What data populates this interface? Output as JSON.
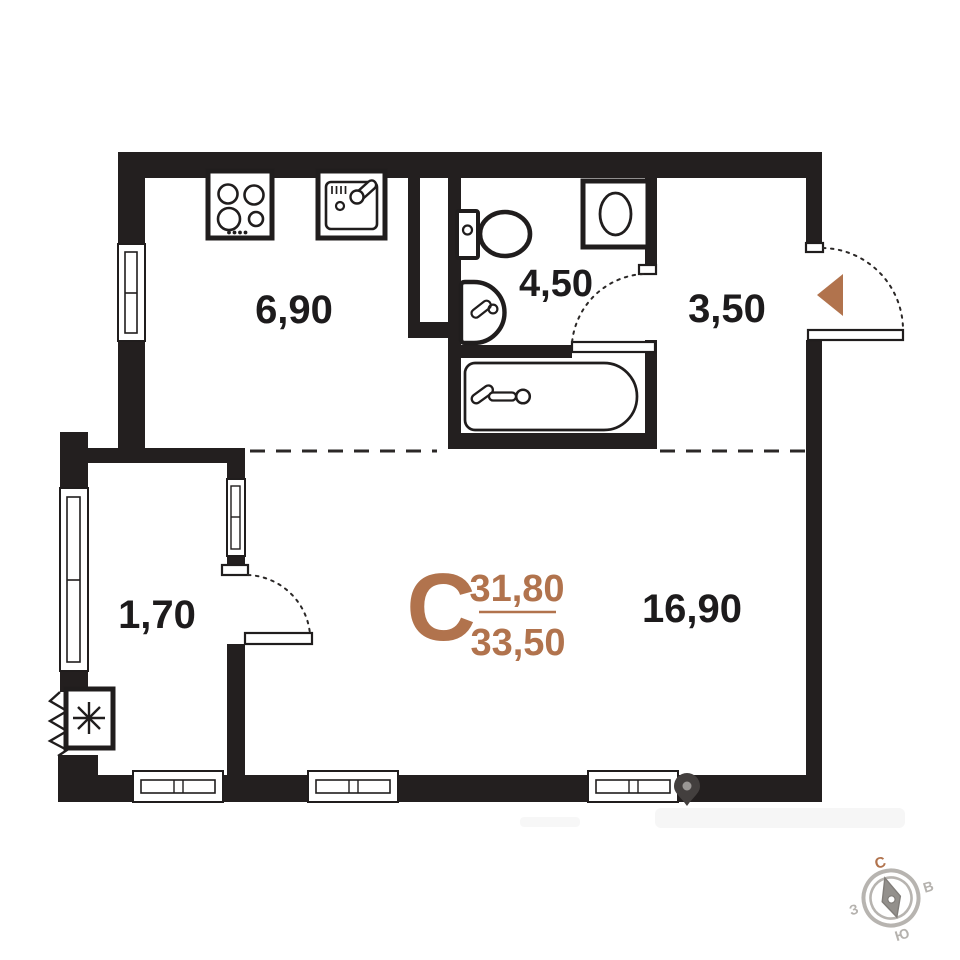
{
  "floor_plan": {
    "rooms": [
      {
        "name": "kitchen-zone",
        "area": "6,90"
      },
      {
        "name": "bathroom",
        "area": "4,50"
      },
      {
        "name": "hallway",
        "area": "3,50"
      },
      {
        "name": "wardrobe",
        "area": "1,70"
      },
      {
        "name": "living-zone",
        "area": "16,90"
      }
    ],
    "summary": {
      "section_letter": "С",
      "area_upper": "31,80",
      "area_lower": "33,50"
    },
    "compass": {
      "north": "С",
      "east": "В",
      "south": "Ю",
      "west": "З"
    },
    "colors": {
      "wall": "#231f1f",
      "accent_brown": "#b1734d",
      "compass_gray": "#b5b2ae",
      "label_dark": "#1d1b1c"
    },
    "fixtures": [
      "stove-icon",
      "kitchen-sink-icon",
      "toilet-icon",
      "washing-machine-icon",
      "bathroom-sink-icon",
      "bathtub-icon",
      "ac-unit-icon",
      "entrance-arrow-icon",
      "location-pin-icon",
      "compass-rose-icon"
    ]
  }
}
